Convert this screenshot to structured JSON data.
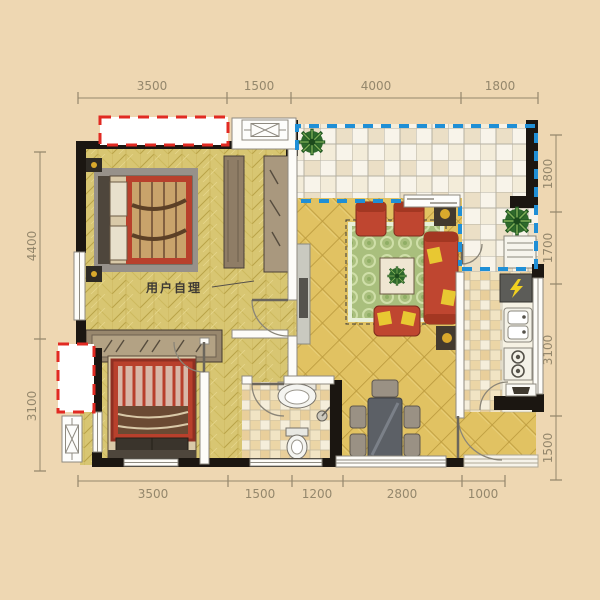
{
  "plan": {
    "annotation": "用户自理",
    "annotation_leader": "line-to-door"
  },
  "dimensions": {
    "top": [
      "3500",
      "1500",
      "4000",
      "1800"
    ],
    "bottom": [
      "3500",
      "1500",
      "1200",
      "2800",
      "1000"
    ],
    "left": [
      "4400",
      "3100"
    ],
    "right": [
      "1800",
      "1700",
      "3100",
      "1500"
    ]
  },
  "icons": [
    "double-bed",
    "wardrobe",
    "sliding-closet",
    "tv-cabinet",
    "sofa-set",
    "green-rug",
    "coffee-table",
    "dining-table",
    "dining-chair",
    "toilet",
    "wash-basin",
    "shower-head",
    "kitchen-sink",
    "gas-stove",
    "electric-panel",
    "laundry-unit",
    "plant",
    "ac-platform",
    "window",
    "door-arc",
    "sliding-door"
  ],
  "colors": {
    "background": "#eed7b2",
    "wall": "#1b1611",
    "red_dash": "#e12a22",
    "blue_dash": "#1f8fd6",
    "floor_bedroom": "#d8c672",
    "floor_living": "#e1c262",
    "floor_tile": "#f8f4ea",
    "rug_green": "#a9bf7d",
    "sofa_red": "#bf4630",
    "dim_text": "#94876c"
  }
}
